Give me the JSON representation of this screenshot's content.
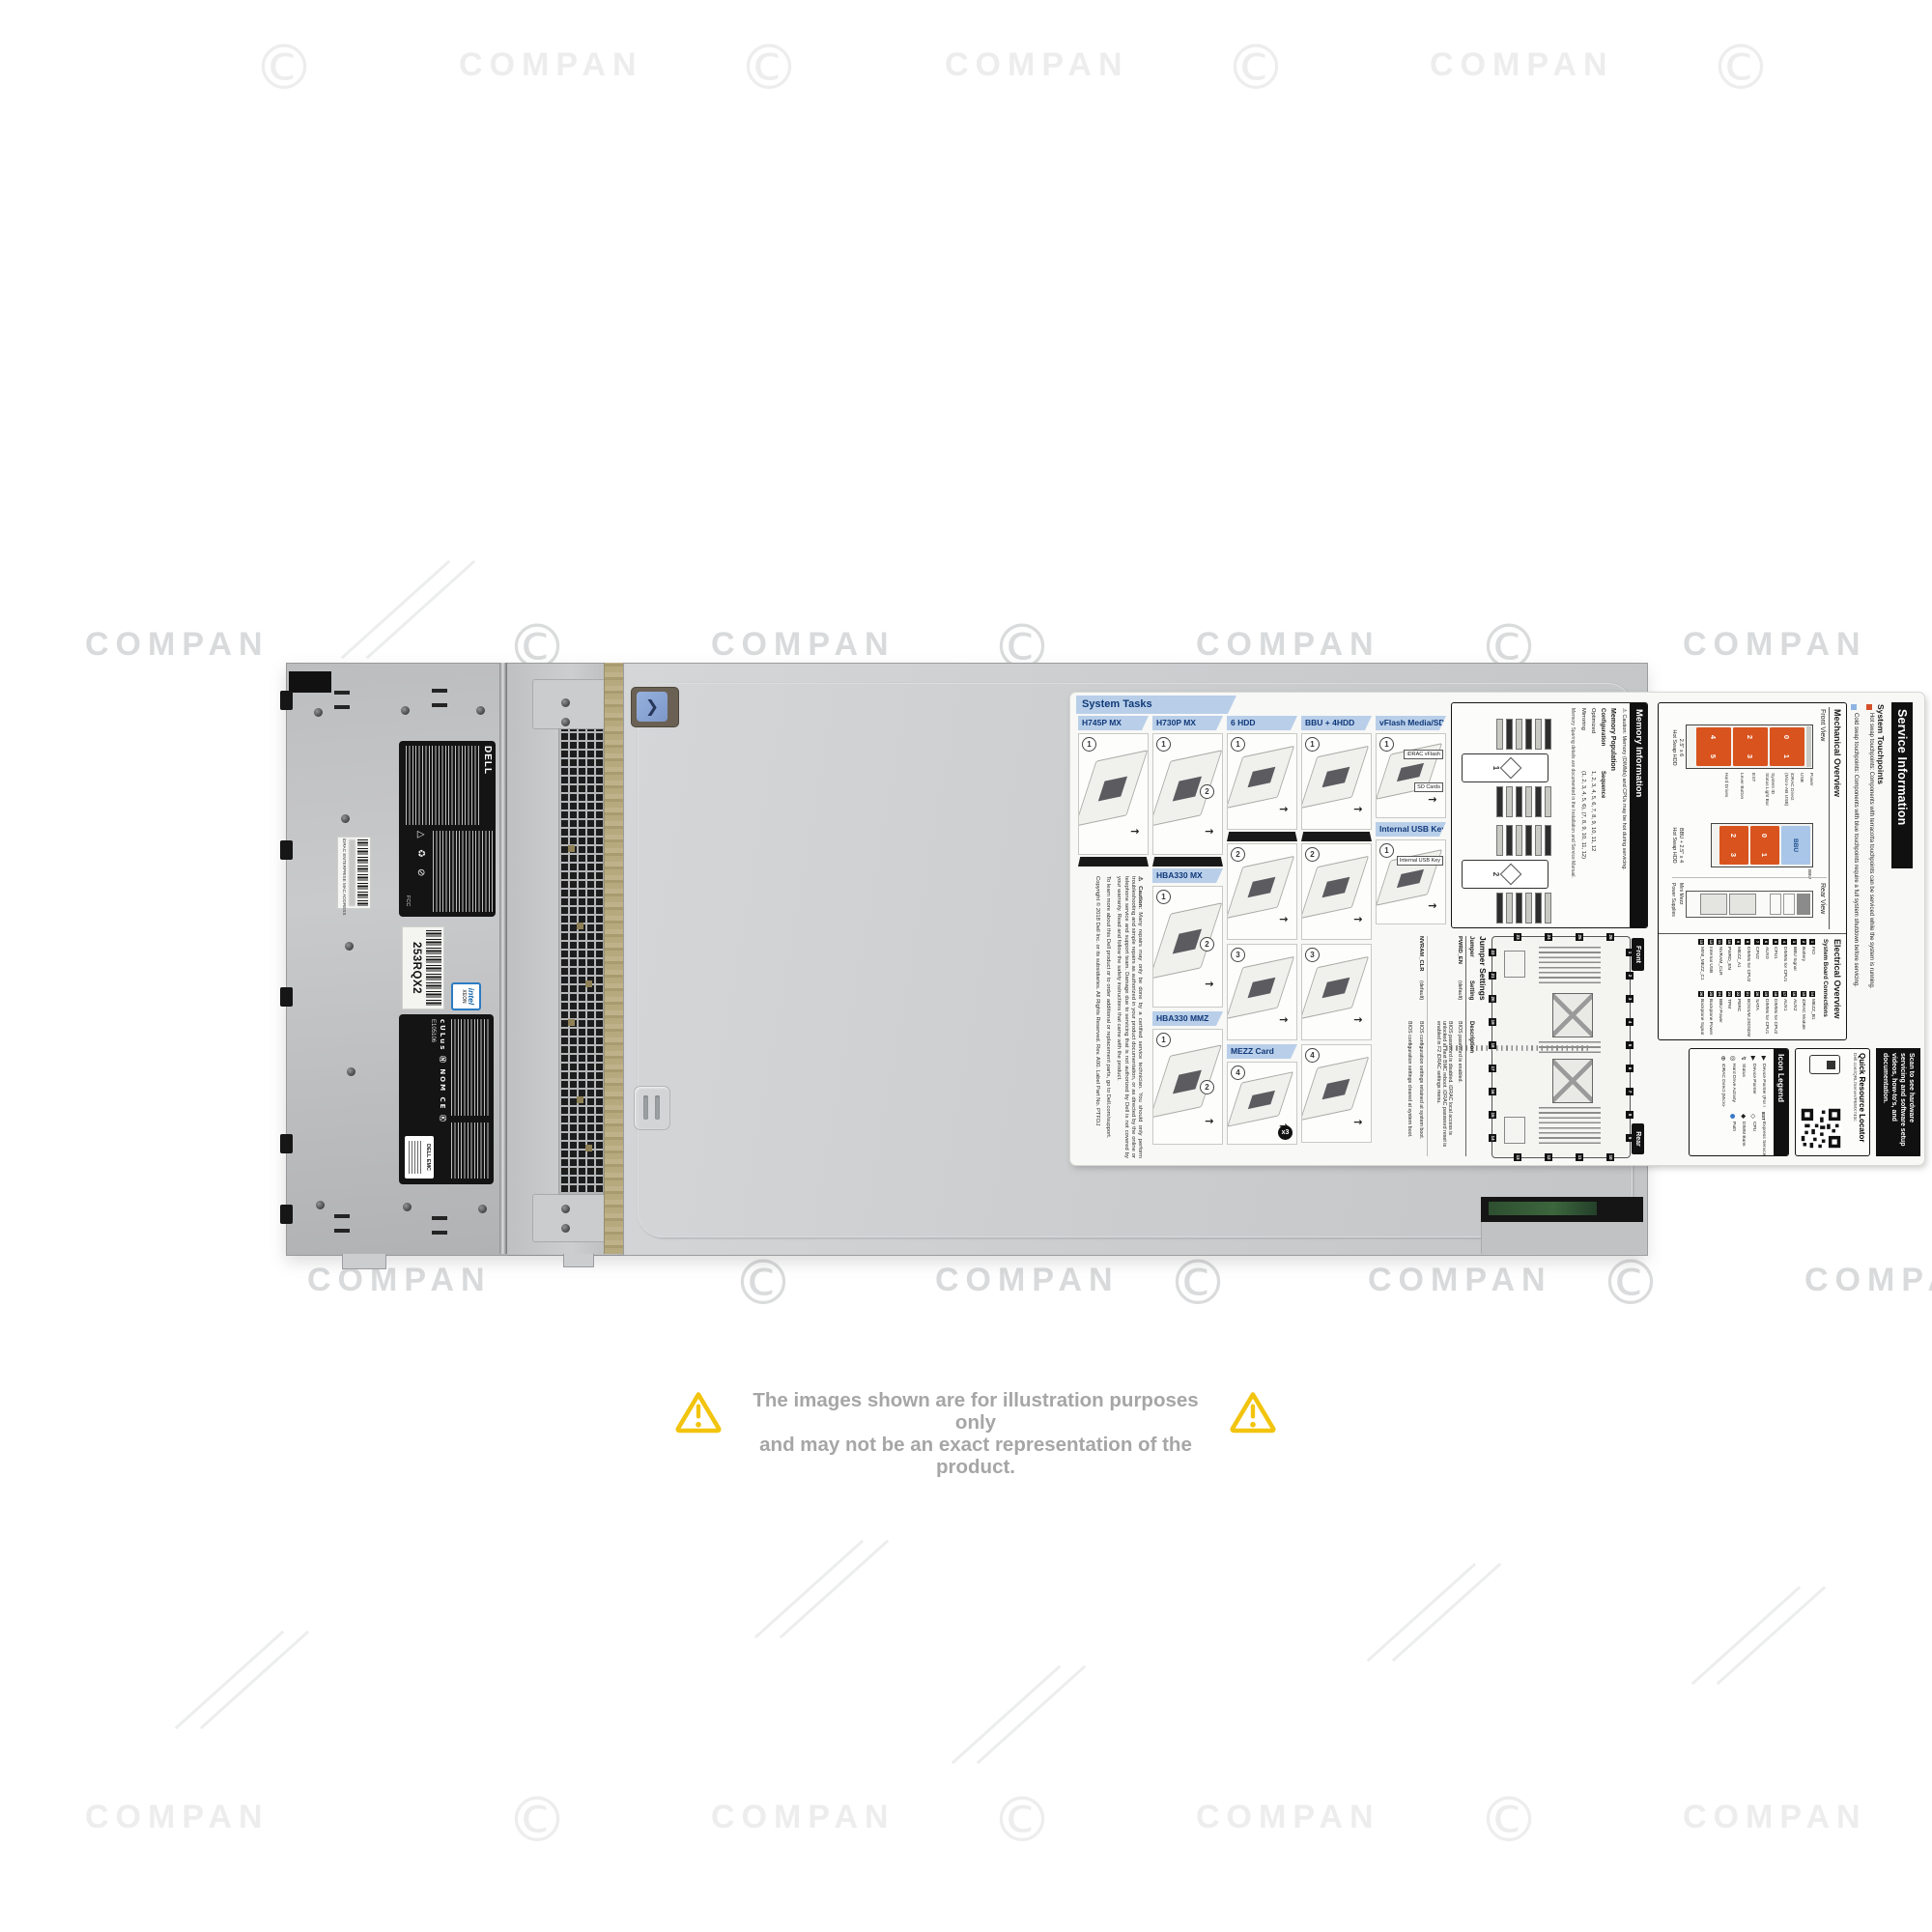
{
  "watermark": {
    "text": "COMPAN"
  },
  "disclaimer": {
    "line1": "The images shown are for illustration purposes only",
    "line2": "and may not be an exact representation of the product."
  },
  "chassis": {
    "dell": "DELL",
    "fcc": "FCC",
    "marks": "cULus Ⓝ NOM CE Ⓚ",
    "e_number": "E105106",
    "dell_emc": "DELL EMC",
    "mac_label": "iDRAC ENTERPRISE MAC ADDRESS",
    "barcode_text": "253RQX2",
    "intel": "intel",
    "xeon": "XEON",
    "reg_icons": "△ ♻ ⊘"
  },
  "tasks": {
    "title": "System Tasks",
    "caution": {
      "head": "Caution:",
      "body": "Many repairs may only be done by a certified service technician. You should only perform troubleshooting and simple repairs as authorized in your product documentation, or as directed by the online or telephone service and support team. Damage due to servicing that is not authorized by Dell is not covered by your warranty. Read and follow the safety instructions that came with the product.",
      "more": "To learn more about this Dell product or to order additional or replacement parts, go to Dell.com/support.",
      "copyright": "Copyright © 2018 Dell Inc. or its subsidiaries. All Rights Reserved. Rev. A00. Label Part No. PTFDJ"
    },
    "columns": [
      {
        "blocks": [
          {
            "h": "H745P MX"
          },
          {
            "p": 126,
            "steps": [
              1
            ],
            "wedge": 1
          },
          {
            "caution": 1
          }
        ]
      },
      {
        "blocks": [
          {
            "h": "H730P MX"
          },
          {
            "p": 126,
            "steps": [
              1,
              2
            ],
            "wedge": 1
          },
          {
            "h": "HBA330 MX"
          },
          {
            "p": 126,
            "steps": [
              1,
              2
            ]
          },
          {
            "h": "HBA330 MMZ"
          },
          {
            "p": 120,
            "steps": [
              1,
              2
            ]
          }
        ]
      },
      {
        "blocks": [
          {
            "h": "6 HDD"
          },
          {
            "p": 100,
            "steps": [
              1
            ],
            "wedge": 1
          },
          {
            "p": 100,
            "steps": [
              2
            ]
          },
          {
            "p": 100,
            "steps": [
              3
            ]
          },
          {
            "h": "MEZZ Card"
          },
          {
            "p": 86,
            "steps": [
              4
            ],
            "badge": "x3"
          }
        ]
      },
      {
        "blocks": [
          {
            "h": "BBU + 4HDD"
          },
          {
            "p": 100,
            "steps": [
              1
            ],
            "wedge": 1
          },
          {
            "p": 100,
            "steps": [
              2
            ]
          },
          {
            "p": 100,
            "steps": [
              3
            ]
          },
          {
            "p": 102,
            "steps": [
              4
            ]
          }
        ]
      },
      {
        "blocks": [
          {
            "h": "vFlash Media/SD Card"
          },
          {
            "p": 88,
            "steps": [
              1
            ],
            "callouts": [
              "iDRAC vFlash",
              "SD Cards"
            ]
          },
          {
            "h": "Internal USB Key"
          },
          {
            "p": 88,
            "steps": [
              1
            ],
            "callouts": [
              "Internal USB Key"
            ]
          }
        ]
      }
    ]
  },
  "service": {
    "header": "Service Information",
    "touchpoints": {
      "title": "System Touchpoints",
      "hot": "Hot swap touchpoints: Components with terracotta touchpoints can be serviced while the system is running.",
      "cold": "Cold swap touchpoints: Components with blue touchpoints require a full system shutdown before servicing."
    },
    "scan": "Scan to see hardware servicing and software setup videos, how-to's, and documentation.",
    "qrl": {
      "title": "Quick Resource Locator",
      "url": "Dell.com/QRL/Server/PEMX740c"
    },
    "icon_legend": {
      "title": "Icon Legend",
      "col1": [
        [
          "▶",
          "Device Pointer (For more direction)"
        ],
        [
          "▶",
          "Device Pointer"
        ],
        [
          "↯",
          "Status"
        ],
        [
          "◎",
          "Hard Drive Activity"
        ],
        [
          "⊕",
          "iDRAC Direct (Micro-AB USB)"
        ]
      ],
      "col2": [
        [
          "EST",
          "Express Service Tag"
        ],
        [
          "◇",
          "CPU"
        ],
        [
          "◆",
          "DIMM Bank"
        ],
        [
          "●",
          "Path"
        ]
      ]
    },
    "mech": {
      "title": "Mechanical Overview",
      "front": "Front View",
      "rear": "Rear View",
      "fv1a": "2.5\" x 6",
      "fv1b": "Hot Swap HDD",
      "fv2a": "BBU + 2.5\" x 4",
      "fv2b": "Hot Swap HDD",
      "bays1": [
        [
          "0",
          "1"
        ],
        [
          "2",
          "3"
        ],
        [
          "4",
          "5"
        ]
      ],
      "bays2": [
        [
          "0",
          "1"
        ],
        [
          "2",
          "3"
        ]
      ],
      "bbu": "BBU",
      "callouts": [
        "Power",
        "USB",
        "iDRAC Direct",
        "(Micro-AB USB)",
        "System ID",
        "Status Light Bar",
        "EST",
        "Lever Button",
        "Hard Drives"
      ],
      "bbu_callout": "BBU",
      "rear_labels": [
        "Mini Mezz",
        "Power Supplies"
      ]
    },
    "elec": {
      "title": "Electrical Overview",
      "sub": "System Board Connections",
      "items": [
        {
          "n": "1",
          "t": "FIO"
        },
        {
          "n": "2",
          "t": "Battery"
        },
        {
          "n": "3",
          "t": "BBU Signal"
        },
        {
          "n": "4",
          "t": "DIMMs for CPU1"
        },
        {
          "n": "5",
          "t": "CPU1"
        },
        {
          "n": "6",
          "t": "AUX0"
        },
        {
          "n": "7",
          "t": "CPU2"
        },
        {
          "n": "8",
          "t": "DIMMs for CPU2"
        },
        {
          "n": "9",
          "t": "MEZZ_A1"
        },
        {
          "n": "10",
          "t": "PWRD_EN"
        },
        {
          "n": "11",
          "t": "NVRAM_CLR"
        },
        {
          "n": "12",
          "t": "Internal USB"
        },
        {
          "n": "13",
          "t": "MINI_MEZZ_C1"
        },
        {
          "n": "14",
          "t": "MEZZ_B1"
        },
        {
          "n": "15",
          "t": "iDRAC Module"
        },
        {
          "n": "16",
          "t": "AUX2"
        },
        {
          "n": "17",
          "t": "AUX1"
        },
        {
          "n": "18",
          "t": "DIMMs for CPU2"
        },
        {
          "n": "19",
          "t": "DIMMs for CPU1"
        },
        {
          "n": "20",
          "t": "SATA"
        },
        {
          "n": "21",
          "t": "BOSS/M.2/IDSDM"
        },
        {
          "n": "22",
          "t": "PERC"
        },
        {
          "n": "23",
          "t": "TPM"
        },
        {
          "n": "24",
          "t": "BBU Power"
        },
        {
          "n": "25",
          "t": "Backplane Power"
        },
        {
          "n": "26",
          "t": "Backplane Signal"
        }
      ]
    },
    "memory": {
      "title": "Memory Information",
      "caution": "⚠ Caution: Memory (DIMMs) and CPUs may be hot during servicing.",
      "pop": "Memory Population",
      "cfg": "Configuration",
      "seq": "Sequence",
      "rows": [
        [
          "Optimized",
          "1, 2, 3, 4, 5, 6, 7, 8, 9, 10, 11, 12"
        ],
        [
          "Mirroring",
          "(1, 2, 3, 4, 5, 6), (7, 8, 9, 10, 11, 12)"
        ]
      ],
      "note": "Memory Sparing details are documented in the Installation and Service Manual.",
      "cpu1": "1",
      "cpu2": "2"
    },
    "jumpers": {
      "title": "Jumper Settings",
      "front": "Front",
      "rear": "Rear",
      "cols": [
        "Jumper",
        "Setting",
        "Description"
      ],
      "rows": [
        {
          "j": "PWRD_EN",
          "s1": "(default)",
          "d1": "BIOS password is enabled.",
          "s2": "",
          "d2": "BIOS password is disabled. iDRAC local access is unlocked at next BMC reboot. iDRAC password reset is enabled in F2 iDRAC settings menu."
        },
        {
          "j": "NVRAM_CLR",
          "s1": "(default)",
          "d1": "BIOS configuration settings retained at system boot.",
          "s2": "",
          "d2": "BIOS configuration settings cleared at system boot."
        }
      ],
      "board": {
        "top": [
          "1",
          "2",
          "3",
          "4",
          "5",
          "6",
          "7",
          "8",
          "9"
        ],
        "right": [
          "10",
          "11",
          "12",
          "13"
        ],
        "bottom": [
          "22",
          "21",
          "20",
          "19",
          "18",
          "17",
          "16",
          "15",
          "14"
        ],
        "left": [
          "26",
          "25",
          "24",
          "23"
        ]
      }
    }
  }
}
